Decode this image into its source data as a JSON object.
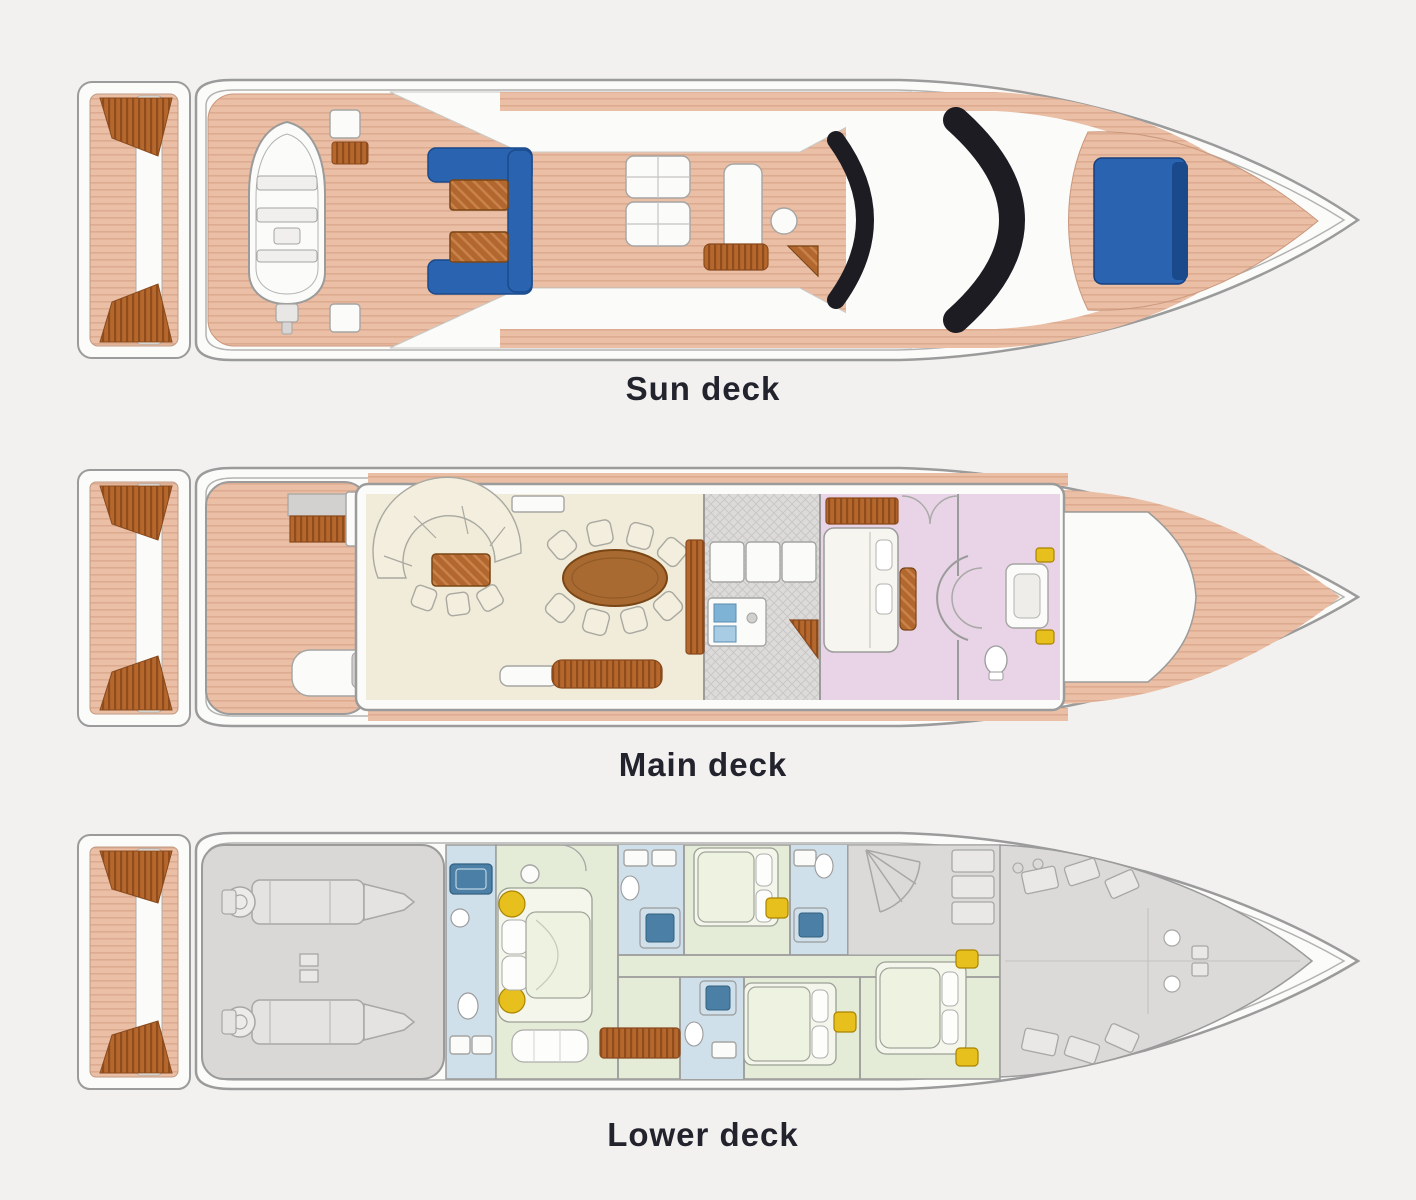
{
  "decks": [
    {
      "id": "sun-deck",
      "label": "Sun deck"
    },
    {
      "id": "main-deck",
      "label": "Main deck"
    },
    {
      "id": "lower-deck",
      "label": "Lower deck"
    }
  ],
  "palette": {
    "background": "#f2f1ef",
    "label_text": "#23232e",
    "hull_white": "#fbfbf9",
    "outline_gray": "#9b9b9b",
    "deck_teak_salmon": "#eabfa5",
    "deck_plank_line": "#d9a78a",
    "stair_teak_brown": "#b5672c",
    "table_wood_brown": "#a86a30",
    "sunpad_blue": "#2a63b0",
    "sunpad_blue_dark": "#1b4a8c",
    "windshield_black": "#1c1c22",
    "salon_cream": "#f1ecd9",
    "galley_gray": "#dcdbd9",
    "master_cabin_pink": "#e8d4e6",
    "guest_cabin_green": "#e4ecd8",
    "bathroom_blue": "#cfe0eb",
    "fixture_blue": "#4b7fa6",
    "accent_yellow": "#e7c01d",
    "engine_room_gray": "#d9d8d6",
    "crew_area_gray": "#dbdad8"
  }
}
